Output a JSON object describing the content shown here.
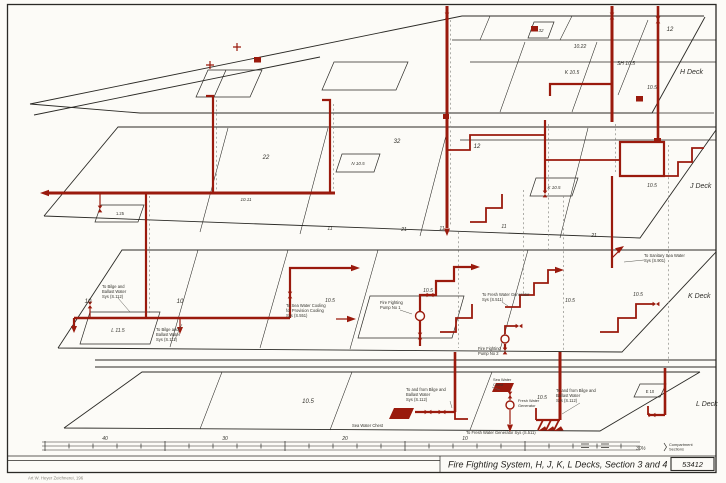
{
  "titleblock": {
    "title": "Fire Fighting System, H, J, K, L Decks, Section 3 and 4",
    "number": "53412"
  },
  "credit": "Art W. Heyer Zeichnerei, 196",
  "colors": {
    "pipe": "#9a1a0d",
    "line": "#2b2a26",
    "dash": "#8b8b85",
    "paper": "#fcfbf7"
  },
  "decks": {
    "h": "H Deck",
    "j": "J Deck",
    "k": "K Deck",
    "l": "L Deck"
  },
  "areas": {
    "h": {
      "r12": "12",
      "r1022": "10.22",
      "rk105": "K 10.5",
      "rsh105": "SH 10.5",
      "r105": "10.5",
      "r32": "32"
    },
    "j": {
      "r22": "22",
      "r32": "32",
      "r12": "12",
      "rn105": "N 10.5",
      "rk105": "K 10.5",
      "r105": "10.5",
      "r1011": "10.11",
      "r125": "1.25",
      "r11a": "11",
      "r21a": "21",
      "r11b": "11",
      "r11c": "11",
      "r21b": "21"
    },
    "k": {
      "r10a": "10",
      "r10b": "10",
      "rl115": "L 11.5",
      "r105a": "10.5",
      "r105b": "10.5",
      "r105c": "10.5",
      "r105d": "10.5"
    },
    "l": {
      "r105a": "10.5",
      "r105b": "10.5",
      "re10": "E 10"
    }
  },
  "equipment": {
    "pump1": {
      "l1": "Fire Fighting",
      "l2": "Pump No 1"
    },
    "pump2": {
      "l1": "Fire Fighting",
      "l2": "Pump No 2"
    },
    "seachest_l": "Sea Water Chest",
    "seachest_r": {
      "l1": "Sea Water",
      "l2": "Chest"
    },
    "fwgen": {
      "l1": "Fresh Water",
      "l2": "Generator"
    }
  },
  "conns": {
    "bilge_a": {
      "l1": "To Bilge and",
      "l2": "Ballast Water",
      "l3": "Sys (S.112)"
    },
    "bilge_b": {
      "l1": "To Bilge and",
      "l2": "Ballast Water",
      "l3": "Sys (S.112)"
    },
    "bilgefrom_a": {
      "l1": "To and from Bilge and",
      "l2": "Ballast Water",
      "l3": "Sys (S.112)"
    },
    "bilgefrom_b": {
      "l1": "To and from Bilge and",
      "l2": "Ballast Water",
      "l3": "Sys (S.112)"
    },
    "provision": {
      "l1": "To Sea Water Cooling",
      "l2": "for Provision Cooling",
      "l3": "Sys (S.551)"
    },
    "fwg_k": {
      "l1": "To Fresh Water Generator",
      "l2": "Sys (S.511)"
    },
    "fwg_l": "To Fresh Water Generator Sys (S.511)",
    "sanitary": {
      "l1": "To Sanitary Sea Water",
      "l2": "Sys (S.901)"
    }
  },
  "scale": {
    "n40": "40",
    "n30": "30",
    "n20": "20",
    "n10": "10",
    "frac": "30½",
    "cap1": "Compartment",
    "cap2": "Sections"
  }
}
